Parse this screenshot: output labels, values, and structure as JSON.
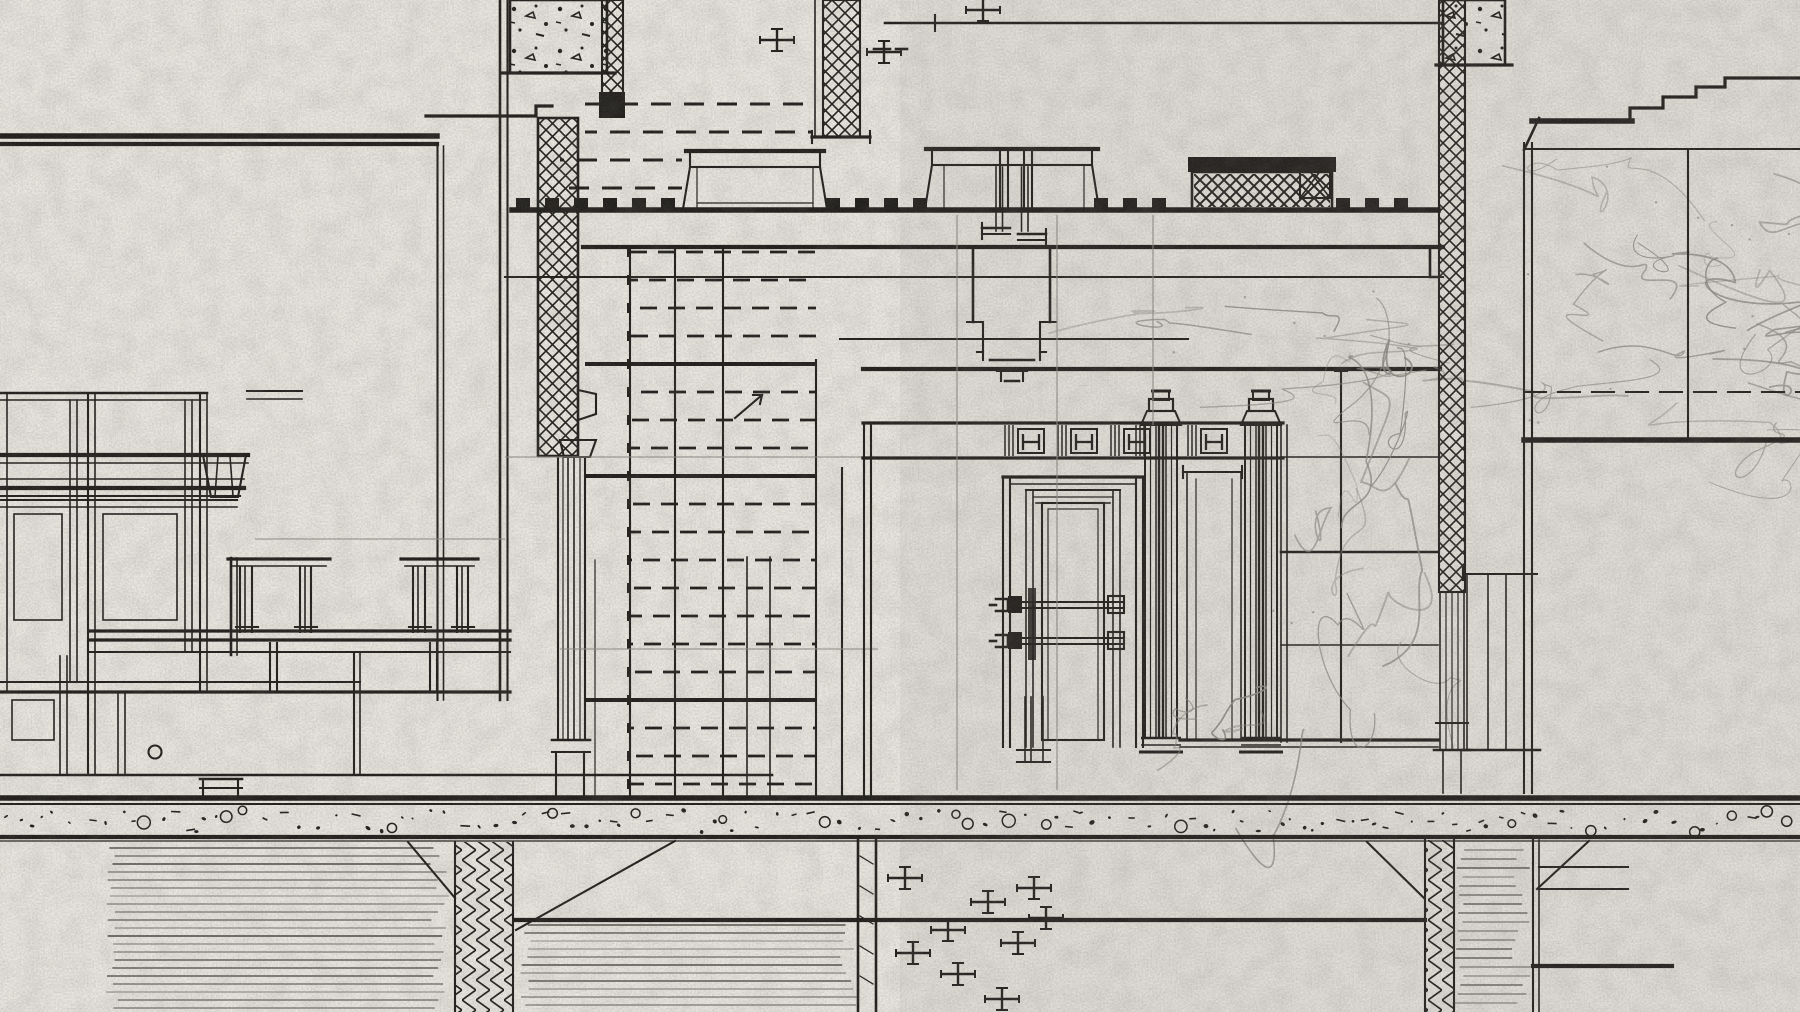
{
  "document": {
    "kind": "scanned architectural drawing",
    "view": "interior section / elevation detail of a stair hall with door, marble wall panels and foundation piers",
    "medium": "ink and pencil linework on textured paper",
    "visible_text": "none"
  },
  "drawing": {
    "palette": {
      "paper": "#ebe9e2",
      "paper_shade": "#dedcd4",
      "ink": "#201e1b",
      "ink_soft": "#3a3733",
      "pencil": "#8f8d86",
      "stripe": "#34322e"
    },
    "seed": 20240613,
    "shaft_rows_upper": [
      [
        104,
        585,
        812
      ],
      [
        132,
        585,
        812
      ],
      [
        160,
        560,
        682
      ],
      [
        188,
        560,
        682
      ]
    ],
    "shaft_rows": {
      "y0": 252,
      "dy": 28,
      "count": 20,
      "x1": 630,
      "x2": 816,
      "solid": [
        364,
        476,
        700
      ],
      "solid_x1": 585
    },
    "merlons": {
      "y": 198,
      "h": 11,
      "w": 14,
      "pitch": 29,
      "groups": [
        [
          516,
          688
        ],
        [
          826,
          932
        ],
        [
          1094,
          1192
        ],
        [
          1336,
          1436
        ]
      ]
    },
    "stripe_blocks": [
      [
        105,
        848,
        345,
        164,
        8
      ],
      [
        518,
        925,
        340,
        87,
        8
      ],
      [
        1452,
        850,
        80,
        162,
        9
      ]
    ],
    "speckle_band": [
      0,
      806,
      1800,
      30
    ],
    "crosses": [
      [
        777,
        40
      ],
      [
        884,
        52
      ],
      [
        983,
        10
      ],
      [
        905,
        878
      ],
      [
        948,
        930
      ],
      [
        988,
        902
      ],
      [
        1034,
        888
      ],
      [
        913,
        953
      ],
      [
        958,
        974
      ],
      [
        1002,
        999
      ],
      [
        1046,
        918
      ],
      [
        1018,
        943
      ]
    ],
    "vein_regions": [
      [
        1282,
        268,
        152,
        470,
        14
      ],
      [
        1526,
        152,
        272,
        282,
        20
      ],
      [
        1150,
        278,
        288,
        92,
        7
      ],
      [
        1185,
        600,
        95,
        140,
        4
      ]
    ]
  }
}
